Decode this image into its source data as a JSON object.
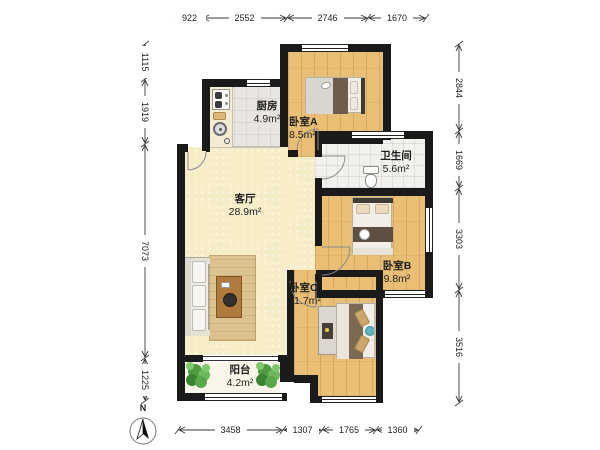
{
  "compass": {
    "north_label": "N"
  },
  "rooms": {
    "kitchen": {
      "name": "厨房",
      "area": "4.9m²"
    },
    "bedroomA": {
      "name": "卧室A",
      "area": "8.5m²"
    },
    "bathroom": {
      "name": "卫生间",
      "area": "5.6m²"
    },
    "living": {
      "name": "客厅",
      "area": "28.9m²"
    },
    "bedroomB": {
      "name": "卧室B",
      "area": "9.8m²"
    },
    "bedroomC": {
      "name": "卧室C",
      "area": "11.7m²"
    },
    "balcony": {
      "name": "阳台",
      "area": "4.2m²"
    }
  },
  "dims": {
    "top": [
      "922",
      "2552",
      "2746",
      "1670"
    ],
    "bottom": [
      "3458",
      "1307",
      "1765",
      "1360"
    ],
    "left": [
      "1115",
      "1919",
      "7073",
      "1225"
    ],
    "right": [
      "2844",
      "1669",
      "3303",
      "3516"
    ]
  },
  "colors": {
    "wall": "#1a1a1a",
    "wood_floor": "#e8bf74",
    "living_floor": "#f6ecc6",
    "kitchen_floor": "#e9e6e2",
    "bath_floor": "#f2f1ee",
    "balcony_floor": "#f8f5e9",
    "plant_green": "#58a94a",
    "teal_pillow": "#5fb6c2",
    "rug": "#dcc28f"
  }
}
